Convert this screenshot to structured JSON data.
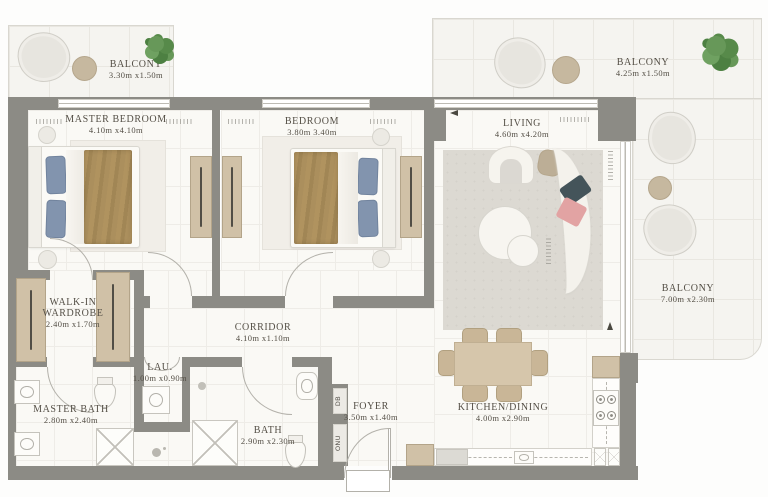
{
  "rooms": {
    "balcony_tl": {
      "name": "BALCONY",
      "dims": "3.30m x1.50m"
    },
    "master_bedroom": {
      "name": "MASTER BEDROOM",
      "dims": "4.10m x4.10m"
    },
    "bedroom": {
      "name": "BEDROOM",
      "dims": "3.80m 3.40m"
    },
    "living": {
      "name": "LIVING",
      "dims": "4.60m x4.20m"
    },
    "balcony_tr": {
      "name": "BALCONY",
      "dims": "4.25m x1.50m"
    },
    "balcony_r": {
      "name": "BALCONY",
      "dims": "7.00m x2.30m"
    },
    "walkin": {
      "name": "WALK-IN WARDROBE",
      "dims": "2.40m x1.70m"
    },
    "corridor": {
      "name": "CORRIDOR",
      "dims": "4.10m x1.10m"
    },
    "lau": {
      "name": "LAU.",
      "dims": "1.00m x0.90m"
    },
    "master_bath": {
      "name": "MASTER BATH",
      "dims": "2.80m x2.40m"
    },
    "bath": {
      "name": "BATH",
      "dims": "2.90m x2.30m"
    },
    "foyer": {
      "name": "FOYER",
      "dims": "3.50m x1.40m"
    },
    "kitchen_dining": {
      "name": "KITCHEN/DINING",
      "dims": "4.00m x2.90m"
    }
  },
  "utility": {
    "db": "DB",
    "onu": "ONU"
  },
  "colors": {
    "wall": "#8c8b85",
    "floor": "#faf9f5",
    "balcony_floor": "#f5f4f0",
    "wood_closet": "#d0c1a7",
    "blanket_brown": "#ab8f5d",
    "pillow_blue": "#8294ae",
    "tree_green": "#679859",
    "sofa_pillow_teal": "#44545a",
    "sofa_pillow_pink": "#e2a3a3",
    "dining_wood": "#d6c6ab"
  }
}
